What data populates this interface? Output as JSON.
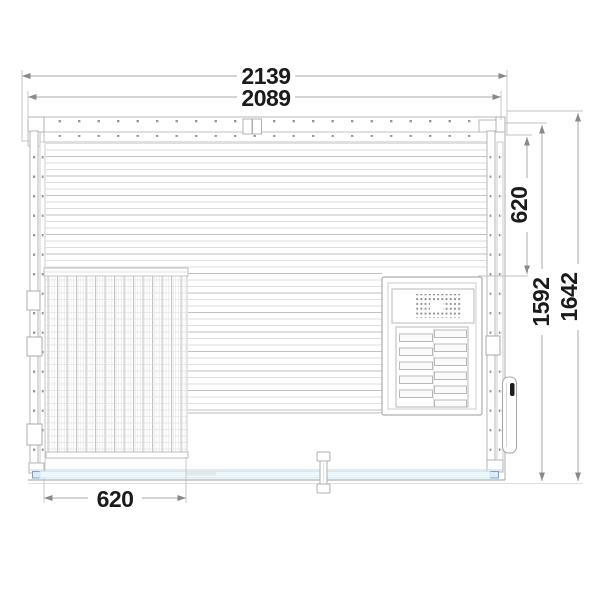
{
  "drawing": {
    "title": "sauna-cabin-technical-plan",
    "dimensions": {
      "width_overall": "2139",
      "width_interior": "2089",
      "heater_offset": "620",
      "depth_interior": "1592",
      "depth_overall": "1642",
      "bench_width": "620"
    },
    "colors": {
      "line": "#b4b4b4",
      "line_light": "#d6d6d6",
      "dim_line": "#a8a8a8",
      "arrow": "#8a8a8a",
      "text": "#1b1b1b",
      "glass_band": "#ecf7fb",
      "glass_edge": "#c9e6f2",
      "accent_blue": "#6b9bd2"
    }
  }
}
